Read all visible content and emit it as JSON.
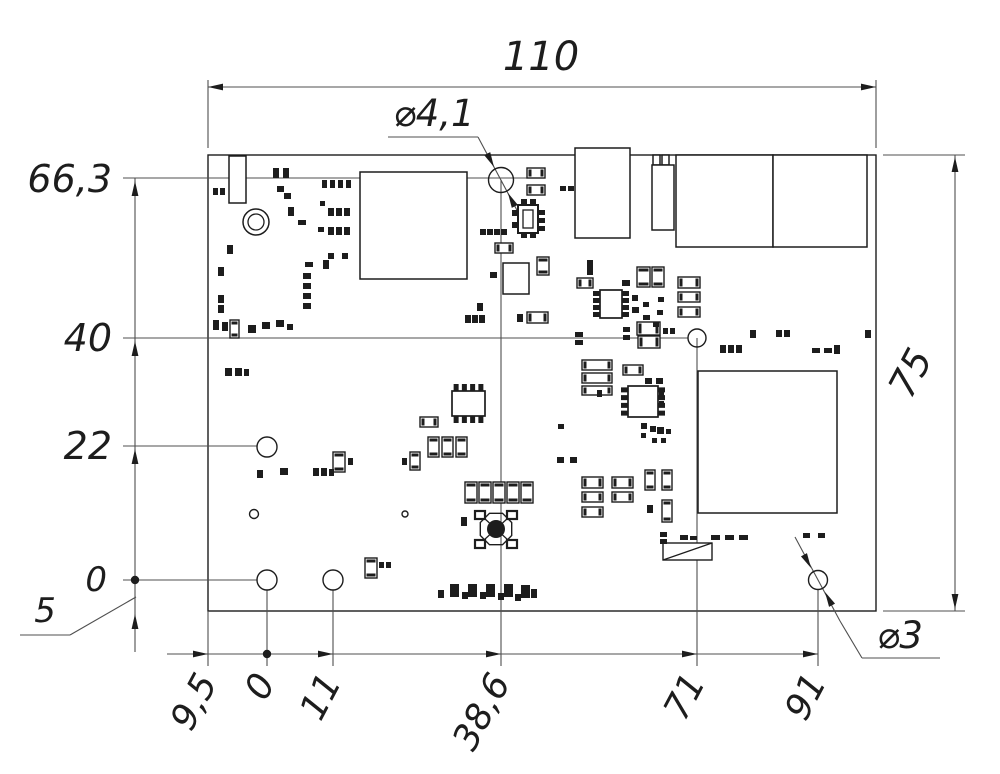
{
  "meta": {
    "type": "mechanical-dimension-drawing",
    "subject": "PCB outline with component placement and ordinate dimensions",
    "units": "mm"
  },
  "dimensions": {
    "board_width_label": "110",
    "board_height_label": "75",
    "hole_callout_large": "⌀4,1",
    "hole_callout_small": "⌀3",
    "left_ordinates": [
      "66,3",
      "40",
      "22",
      "0",
      "5"
    ],
    "bottom_ordinates": [
      "9,5",
      "0",
      "11",
      "38,6",
      "71",
      "91"
    ]
  },
  "style": {
    "bg": "#ffffff",
    "part_line": "#1d1d1d",
    "dim_line": "#4f4f4f",
    "text_color": "#1d1d1d"
  },
  "render": {
    "board": {
      "x": 208,
      "y": 155,
      "w": 668,
      "h": 456
    },
    "texts": [
      {
        "s": "110",
        "x": 541,
        "y": 70,
        "size": 40,
        "rot": 0,
        "anchor": "middle",
        "name": "dim-width-110"
      },
      {
        "s": "66,3",
        "x": 112,
        "y": 192,
        "size": 38,
        "rot": 0,
        "anchor": "end",
        "name": "ordinate-66-3"
      },
      {
        "s": "40",
        "x": 112,
        "y": 351,
        "size": 38,
        "rot": 0,
        "anchor": "end",
        "name": "ordinate-40"
      },
      {
        "s": "22",
        "x": 112,
        "y": 459,
        "size": 38,
        "rot": 0,
        "anchor": "end",
        "name": "ordinate-22"
      },
      {
        "s": "0",
        "x": 107,
        "y": 591,
        "size": 34,
        "rot": 0,
        "anchor": "end",
        "name": "ordinate-0-left"
      },
      {
        "s": "5",
        "x": 45,
        "y": 622,
        "size": 34,
        "rot": 0,
        "anchor": "middle",
        "name": "ordinate-5"
      },
      {
        "s": "⌀4,1",
        "x": 434,
        "y": 126,
        "size": 37,
        "rot": 0,
        "anchor": "middle",
        "name": "hole-callout-4-1"
      },
      {
        "s": "⌀3",
        "x": 900,
        "y": 648,
        "size": 37,
        "rot": 0,
        "anchor": "middle",
        "name": "hole-callout-3"
      },
      {
        "s": "75",
        "x": 922,
        "y": 379,
        "size": 38,
        "rot": -62,
        "anchor": "middle",
        "name": "dim-height-75"
      },
      {
        "s": "9,5",
        "x": 218,
        "y": 682,
        "size": 36,
        "rot": -62,
        "anchor": "end",
        "name": "ordinate-9-5"
      },
      {
        "s": "0",
        "x": 276,
        "y": 682,
        "size": 36,
        "rot": -62,
        "anchor": "end",
        "name": "ordinate-0-bottom"
      },
      {
        "s": "11",
        "x": 342,
        "y": 682,
        "size": 36,
        "rot": -62,
        "anchor": "end",
        "name": "ordinate-11"
      },
      {
        "s": "38,6",
        "x": 511,
        "y": 682,
        "size": 36,
        "rot": -62,
        "anchor": "end",
        "name": "ordinate-38-6"
      },
      {
        "s": "71",
        "x": 706,
        "y": 682,
        "size": 36,
        "rot": -62,
        "anchor": "end",
        "name": "ordinate-71"
      },
      {
        "s": "91",
        "x": 827,
        "y": 682,
        "size": 36,
        "rot": -62,
        "anchor": "end",
        "name": "ordinate-91"
      }
    ],
    "lines": [
      [
        208,
        148,
        208,
        80
      ],
      [
        876,
        148,
        876,
        80
      ],
      [
        208,
        87,
        876,
        87
      ],
      [
        883,
        155,
        965,
        155
      ],
      [
        883,
        611,
        965,
        611
      ],
      [
        955,
        155,
        955,
        611
      ],
      [
        123,
        178,
        540,
        178
      ],
      [
        123,
        338,
        688,
        338
      ],
      [
        123,
        446,
        257,
        446
      ],
      [
        123,
        580,
        257,
        580
      ],
      [
        135,
        178,
        135,
        652
      ],
      [
        20,
        635,
        70,
        635
      ],
      [
        70,
        635,
        136,
        597
      ],
      [
        167,
        654,
        818,
        654
      ],
      [
        208,
        611,
        208,
        666
      ],
      [
        267,
        590,
        267,
        666
      ],
      [
        333,
        590,
        333,
        666
      ],
      [
        501,
        180,
        501,
        666
      ],
      [
        697,
        338,
        697,
        666
      ],
      [
        818,
        589,
        818,
        666
      ],
      [
        388,
        137,
        478,
        137
      ],
      [
        478,
        137,
        519,
        214
      ],
      [
        795,
        537,
        840,
        621
      ],
      [
        840,
        621,
        862,
        658
      ],
      [
        862,
        658,
        940,
        658
      ]
    ],
    "arrows": [
      {
        "x": 208,
        "y": 87,
        "a": 180
      },
      {
        "x": 876,
        "y": 87,
        "a": 0
      },
      {
        "x": 955,
        "y": 157,
        "a": -90
      },
      {
        "x": 955,
        "y": 609,
        "a": 90
      },
      {
        "x": 135,
        "y": 181,
        "a": -90
      },
      {
        "x": 135,
        "y": 341,
        "a": -90
      },
      {
        "x": 135,
        "y": 449,
        "a": -90
      },
      {
        "x": 135,
        "y": 614,
        "a": -90
      },
      {
        "x": 208,
        "y": 654,
        "a": 0
      },
      {
        "x": 333,
        "y": 654,
        "a": 0
      },
      {
        "x": 501,
        "y": 654,
        "a": 0
      },
      {
        "x": 697,
        "y": 654,
        "a": 0
      },
      {
        "x": 818,
        "y": 654,
        "a": 0
      },
      {
        "x": 494,
        "y": 167,
        "a": 63
      },
      {
        "x": 508,
        "y": 193,
        "a": 243
      },
      {
        "x": 811,
        "y": 568,
        "a": 62
      },
      {
        "x": 825,
        "y": 592,
        "a": 242
      }
    ],
    "dots": [
      [
        135,
        580
      ],
      [
        267,
        654
      ]
    ],
    "holes": [
      {
        "x": 501,
        "y": 180,
        "r": 12.5,
        "name": "hole-4-1mm"
      },
      {
        "x": 818,
        "y": 580,
        "r": 9.5,
        "name": "hole-3mm"
      },
      {
        "x": 267,
        "y": 580,
        "r": 10,
        "name": "hole-origin"
      },
      {
        "x": 333,
        "y": 580,
        "r": 10,
        "name": "hole-11-0"
      },
      {
        "x": 267,
        "y": 447,
        "r": 10,
        "name": "hole-0-22"
      },
      {
        "x": 697,
        "y": 338,
        "r": 9,
        "name": "hole-71-40"
      },
      {
        "x": 254,
        "y": 514,
        "r": 4.5,
        "name": "via"
      },
      {
        "x": 405,
        "y": 514,
        "r": 3,
        "name": "via"
      }
    ],
    "ring": {
      "x": 256,
      "y": 222,
      "r1": 13,
      "r2": 8
    },
    "rects": [
      [
        229,
        156,
        17,
        47
      ],
      [
        360,
        172,
        107,
        107
      ],
      [
        575,
        148,
        55,
        90
      ],
      [
        653,
        155,
        7,
        10
      ],
      [
        662,
        155,
        7,
        10
      ],
      [
        652,
        165,
        22,
        65
      ],
      [
        676,
        155,
        97,
        92
      ],
      [
        773,
        155,
        94,
        92
      ],
      [
        503,
        263,
        26,
        31
      ],
      [
        698,
        371,
        139,
        142
      ]
    ],
    "relay": {
      "x": 663,
      "y": 543,
      "w": 49,
      "h": 17
    },
    "ic_small": {
      "bx": 518,
      "by": 205,
      "bw": 20,
      "bh": 28,
      "ix": 523,
      "iy": 210,
      "iw": 10,
      "ih": 18
    },
    "crystal": {
      "cx": 496,
      "cy": 529,
      "r": 17,
      "dotr": 9,
      "pads": [
        [
          475,
          511,
          10,
          8
        ],
        [
          507,
          511,
          10,
          8
        ],
        [
          475,
          540,
          10,
          8
        ],
        [
          507,
          540,
          10,
          8
        ]
      ]
    },
    "soics": [
      {
        "x": 452,
        "y": 391,
        "w": 33,
        "h": 25,
        "dir": "tb"
      },
      {
        "x": 600,
        "y": 290,
        "w": 22,
        "h": 28,
        "dir": "lr"
      },
      {
        "x": 628,
        "y": 386,
        "w": 30,
        "h": 31,
        "dir": "lr"
      }
    ],
    "caps": [
      [
        577,
        278,
        16,
        10
      ],
      [
        637,
        267,
        13,
        20
      ],
      [
        652,
        267,
        12,
        20
      ],
      [
        678,
        277,
        22,
        11
      ],
      [
        678,
        292,
        22,
        10
      ],
      [
        678,
        307,
        22,
        10
      ],
      [
        582,
        360,
        30,
        10
      ],
      [
        582,
        373,
        30,
        10
      ],
      [
        582,
        386,
        30,
        9
      ],
      [
        623,
        365,
        20,
        10
      ],
      [
        582,
        477,
        21,
        11
      ],
      [
        612,
        477,
        21,
        11
      ],
      [
        582,
        492,
        21,
        10
      ],
      [
        612,
        492,
        21,
        10
      ],
      [
        582,
        507,
        21,
        10
      ],
      [
        645,
        470,
        10,
        20
      ],
      [
        662,
        470,
        10,
        20
      ],
      [
        662,
        500,
        10,
        22
      ],
      [
        465,
        482,
        12,
        21
      ],
      [
        479,
        482,
        12,
        21
      ],
      [
        493,
        482,
        12,
        21
      ],
      [
        507,
        482,
        12,
        21
      ],
      [
        521,
        482,
        12,
        21
      ],
      [
        428,
        437,
        11,
        20
      ],
      [
        442,
        437,
        11,
        20
      ],
      [
        456,
        437,
        11,
        20
      ],
      [
        410,
        452,
        10,
        18
      ],
      [
        420,
        417,
        18,
        10
      ],
      [
        333,
        452,
        12,
        20
      ],
      [
        365,
        558,
        12,
        20
      ],
      [
        527,
        168,
        18,
        10
      ],
      [
        527,
        185,
        18,
        10
      ],
      [
        495,
        243,
        18,
        10
      ],
      [
        537,
        257,
        12,
        18
      ],
      [
        527,
        312,
        21,
        11
      ],
      [
        637,
        322,
        23,
        13
      ],
      [
        638,
        336,
        22,
        12
      ],
      [
        230,
        320,
        9,
        18
      ]
    ],
    "pads": [
      [
        213,
        188,
        5,
        7
      ],
      [
        220,
        188,
        5,
        7
      ],
      [
        273,
        168,
        6,
        10
      ],
      [
        283,
        168,
        6,
        10
      ],
      [
        277,
        186,
        7,
        6
      ],
      [
        284,
        193,
        7,
        6
      ],
      [
        288,
        207,
        6,
        9
      ],
      [
        298,
        220,
        8,
        5
      ],
      [
        322,
        180,
        5,
        8
      ],
      [
        330,
        180,
        5,
        8
      ],
      [
        338,
        180,
        5,
        8
      ],
      [
        346,
        180,
        5,
        8
      ],
      [
        320,
        201,
        5,
        5
      ],
      [
        328,
        208,
        6,
        8
      ],
      [
        336,
        208,
        6,
        8
      ],
      [
        344,
        208,
        6,
        8
      ],
      [
        318,
        227,
        6,
        5
      ],
      [
        328,
        227,
        6,
        8
      ],
      [
        336,
        227,
        6,
        8
      ],
      [
        344,
        227,
        6,
        8
      ],
      [
        227,
        245,
        6,
        9
      ],
      [
        218,
        267,
        6,
        9
      ],
      [
        305,
        262,
        8,
        5
      ],
      [
        323,
        260,
        6,
        9
      ],
      [
        328,
        253,
        6,
        6
      ],
      [
        342,
        253,
        6,
        6
      ],
      [
        303,
        273,
        8,
        6
      ],
      [
        303,
        283,
        8,
        6
      ],
      [
        303,
        293,
        8,
        6
      ],
      [
        303,
        303,
        8,
        6
      ],
      [
        218,
        295,
        6,
        8
      ],
      [
        218,
        305,
        6,
        8
      ],
      [
        213,
        320,
        6,
        10
      ],
      [
        222,
        322,
        6,
        9
      ],
      [
        248,
        325,
        8,
        8
      ],
      [
        262,
        322,
        8,
        7
      ],
      [
        276,
        320,
        8,
        7
      ],
      [
        287,
        324,
        6,
        6
      ],
      [
        225,
        368,
        7,
        8
      ],
      [
        235,
        368,
        7,
        8
      ],
      [
        244,
        369,
        5,
        7
      ],
      [
        480,
        229,
        6,
        6
      ],
      [
        487,
        229,
        6,
        6
      ],
      [
        494,
        229,
        6,
        6
      ],
      [
        501,
        229,
        6,
        6
      ],
      [
        490,
        272,
        7,
        6
      ],
      [
        477,
        303,
        6,
        8
      ],
      [
        465,
        315,
        6,
        8
      ],
      [
        472,
        315,
        6,
        8
      ],
      [
        479,
        315,
        6,
        8
      ],
      [
        517,
        314,
        6,
        8
      ],
      [
        560,
        186,
        6,
        5
      ],
      [
        568,
        186,
        6,
        5
      ],
      [
        587,
        260,
        6,
        15
      ],
      [
        622,
        280,
        8,
        6
      ],
      [
        632,
        295,
        6,
        6
      ],
      [
        632,
        307,
        7,
        6
      ],
      [
        643,
        302,
        6,
        5
      ],
      [
        658,
        297,
        6,
        5
      ],
      [
        657,
        310,
        6,
        5
      ],
      [
        643,
        315,
        7,
        5
      ],
      [
        653,
        322,
        6,
        5
      ],
      [
        575,
        332,
        8,
        5
      ],
      [
        575,
        340,
        8,
        5
      ],
      [
        623,
        327,
        7,
        5
      ],
      [
        623,
        335,
        7,
        5
      ],
      [
        663,
        328,
        5,
        6
      ],
      [
        670,
        328,
        5,
        6
      ],
      [
        720,
        345,
        6,
        8
      ],
      [
        728,
        345,
        6,
        8
      ],
      [
        736,
        345,
        6,
        8
      ],
      [
        750,
        330,
        6,
        8
      ],
      [
        776,
        330,
        6,
        7
      ],
      [
        784,
        330,
        6,
        7
      ],
      [
        812,
        348,
        8,
        5
      ],
      [
        824,
        348,
        8,
        5
      ],
      [
        834,
        345,
        6,
        9
      ],
      [
        865,
        330,
        6,
        8
      ],
      [
        597,
        390,
        5,
        7
      ],
      [
        659,
        391,
        5,
        6
      ],
      [
        659,
        401,
        5,
        6
      ],
      [
        645,
        378,
        7,
        6
      ],
      [
        656,
        378,
        7,
        6
      ],
      [
        558,
        424,
        6,
        5
      ],
      [
        557,
        457,
        7,
        6
      ],
      [
        570,
        457,
        7,
        6
      ],
      [
        641,
        423,
        6,
        6
      ],
      [
        650,
        426,
        6,
        6
      ],
      [
        641,
        433,
        5,
        5
      ],
      [
        657,
        427,
        7,
        7
      ],
      [
        666,
        429,
        5,
        5
      ],
      [
        652,
        438,
        5,
        5
      ],
      [
        661,
        438,
        5,
        5
      ],
      [
        647,
        505,
        6,
        8
      ],
      [
        257,
        470,
        6,
        8
      ],
      [
        280,
        468,
        8,
        7
      ],
      [
        313,
        468,
        6,
        8
      ],
      [
        321,
        468,
        6,
        8
      ],
      [
        329,
        469,
        5,
        7
      ],
      [
        348,
        458,
        5,
        7
      ],
      [
        402,
        458,
        5,
        7
      ],
      [
        461,
        517,
        6,
        9
      ],
      [
        379,
        562,
        5,
        6
      ],
      [
        386,
        562,
        5,
        6
      ],
      [
        450,
        584,
        9,
        13
      ],
      [
        468,
        584,
        9,
        13
      ],
      [
        486,
        584,
        9,
        13
      ],
      [
        504,
        584,
        9,
        13
      ],
      [
        521,
        585,
        9,
        13
      ],
      [
        438,
        590,
        6,
        8
      ],
      [
        462,
        592,
        6,
        7
      ],
      [
        480,
        592,
        6,
        7
      ],
      [
        498,
        593,
        6,
        7
      ],
      [
        515,
        594,
        6,
        7
      ],
      [
        531,
        589,
        6,
        9
      ],
      [
        512,
        210,
        5,
        6
      ],
      [
        512,
        222,
        5,
        6
      ],
      [
        539,
        210,
        6,
        5
      ],
      [
        539,
        218,
        6,
        5
      ],
      [
        539,
        226,
        6,
        5
      ],
      [
        521,
        199,
        6,
        5
      ],
      [
        530,
        199,
        6,
        5
      ],
      [
        521,
        233,
        6,
        5
      ],
      [
        530,
        233,
        6,
        5
      ],
      [
        660,
        532,
        7,
        5
      ],
      [
        660,
        539,
        7,
        5
      ],
      [
        680,
        535,
        8,
        5
      ],
      [
        690,
        536,
        7,
        4
      ],
      [
        711,
        535,
        9,
        5
      ],
      [
        725,
        535,
        9,
        5
      ],
      [
        739,
        535,
        9,
        5
      ],
      [
        803,
        533,
        7,
        5
      ],
      [
        818,
        533,
        7,
        5
      ]
    ]
  }
}
